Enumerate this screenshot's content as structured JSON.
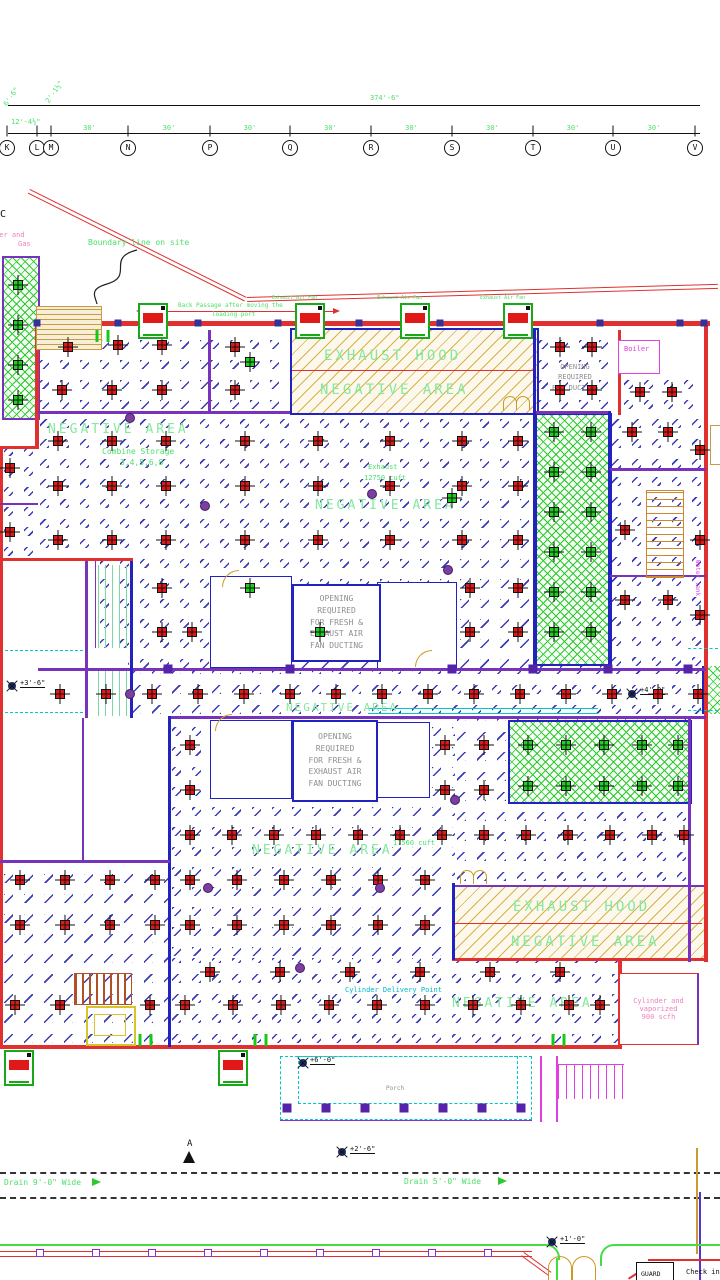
{
  "grid": {
    "xs": [
      7,
      37,
      51,
      128,
      210,
      290,
      371,
      452,
      533,
      613,
      695
    ],
    "bubbles": [
      "K",
      "L",
      "M",
      "N",
      "P",
      "Q",
      "R",
      "S",
      "T",
      "U",
      "V"
    ],
    "total": "374'-6\"",
    "bay": "30'",
    "sub1": "6'-6\"",
    "sub2": "12'-4½\"",
    "sub3": "2'-1½\"",
    "partial": "C"
  },
  "labels": {
    "boundary": "Boundary line on site",
    "back_passage_1": "Back Passage after moving the",
    "back_passage_2": "loading port",
    "exhaust_fan": "Exhaust Air Fan",
    "exhaust_hood": "EXHAUST HOOD",
    "negative_area": "NEGATIVE AREA",
    "combine_1": "Combine Storage",
    "combine_2": "3,4,5,6,8",
    "exhaust_word": "Exhaust",
    "cuft_1": "12750 cuft",
    "cuft_2": "17560 cuft",
    "opening_s": [
      "OPENING",
      "REQUIRED",
      "FOR DUCTING"
    ],
    "opening_f": [
      "OPENING",
      "REQUIRED",
      "FOR FRESH &",
      "EXHAUST AIR",
      "FAN DUCTING"
    ],
    "boiler": "Boiler",
    "water_tank": "Water tank",
    "cylinder": [
      "Cylinder and",
      "vaporized",
      "900 scfh"
    ],
    "corner_note": [
      "Cylinder and",
      "Gas"
    ],
    "delivery": "Cylinder Delivery Point",
    "porch": "Porch",
    "guard": "GUARD",
    "check_in": "Check in",
    "drain_left": "Drain 9'-0\" Wide",
    "drain_right": "Drain 5'-0\" Wide",
    "north": "A",
    "lvl_1": "+3'-6\"",
    "lvl_2": "+4'-0\"",
    "lvl_3": "+6'-0\"",
    "lvl_4": "+2'-6\"",
    "lvl_5": "+1'-0\""
  },
  "colors": {
    "wall_red": "#e03030",
    "wall_blue": "#2222c0",
    "wall_purple": "#7733bb",
    "hatch_blue": "#3a3ab8",
    "hatch_yellow": "#d9b13f",
    "cross_green": "#2ec82e",
    "cad_green": "#4ce06a",
    "cyan": "#00c8c8",
    "magenta": "#e040e0",
    "pink": "#f080c0",
    "gray": "#8f8f8f"
  },
  "symbols": {
    "red_diffusers": [
      [
        68,
        347
      ],
      [
        118,
        345
      ],
      [
        162,
        345
      ],
      [
        62,
        390
      ],
      [
        112,
        390
      ],
      [
        162,
        390
      ],
      [
        235,
        347
      ],
      [
        235,
        390
      ],
      [
        560,
        347
      ],
      [
        592,
        347
      ],
      [
        560,
        390
      ],
      [
        592,
        390
      ],
      [
        640,
        392
      ],
      [
        672,
        392
      ],
      [
        632,
        432
      ],
      [
        668,
        432
      ],
      [
        700,
        450
      ],
      [
        625,
        530
      ],
      [
        700,
        540
      ],
      [
        625,
        600
      ],
      [
        668,
        600
      ],
      [
        700,
        615
      ],
      [
        58,
        441
      ],
      [
        112,
        441
      ],
      [
        166,
        441
      ],
      [
        245,
        441
      ],
      [
        318,
        441
      ],
      [
        390,
        441
      ],
      [
        462,
        441
      ],
      [
        518,
        441
      ],
      [
        58,
        486
      ],
      [
        112,
        486
      ],
      [
        166,
        486
      ],
      [
        245,
        486
      ],
      [
        318,
        486
      ],
      [
        390,
        486
      ],
      [
        462,
        486
      ],
      [
        518,
        486
      ],
      [
        58,
        540
      ],
      [
        112,
        540
      ],
      [
        166,
        540
      ],
      [
        245,
        540
      ],
      [
        318,
        540
      ],
      [
        390,
        540
      ],
      [
        462,
        540
      ],
      [
        518,
        540
      ],
      [
        162,
        588
      ],
      [
        470,
        588
      ],
      [
        518,
        588
      ],
      [
        162,
        632
      ],
      [
        192,
        632
      ],
      [
        470,
        632
      ],
      [
        518,
        632
      ],
      [
        10,
        468
      ],
      [
        10,
        532
      ],
      [
        60,
        694
      ],
      [
        106,
        694
      ],
      [
        152,
        694
      ],
      [
        198,
        694
      ],
      [
        244,
        694
      ],
      [
        290,
        694
      ],
      [
        336,
        694
      ],
      [
        382,
        694
      ],
      [
        428,
        694
      ],
      [
        474,
        694
      ],
      [
        520,
        694
      ],
      [
        566,
        694
      ],
      [
        612,
        694
      ],
      [
        658,
        694
      ],
      [
        698,
        694
      ],
      [
        190,
        745
      ],
      [
        445,
        745
      ],
      [
        484,
        745
      ],
      [
        190,
        790
      ],
      [
        445,
        790
      ],
      [
        484,
        790
      ],
      [
        190,
        835
      ],
      [
        232,
        835
      ],
      [
        274,
        835
      ],
      [
        316,
        835
      ],
      [
        358,
        835
      ],
      [
        400,
        835
      ],
      [
        442,
        835
      ],
      [
        484,
        835
      ],
      [
        526,
        835
      ],
      [
        568,
        835
      ],
      [
        610,
        835
      ],
      [
        652,
        835
      ],
      [
        684,
        835
      ],
      [
        190,
        880
      ],
      [
        237,
        880
      ],
      [
        284,
        880
      ],
      [
        331,
        880
      ],
      [
        378,
        880
      ],
      [
        425,
        880
      ],
      [
        190,
        925
      ],
      [
        237,
        925
      ],
      [
        284,
        925
      ],
      [
        331,
        925
      ],
      [
        378,
        925
      ],
      [
        425,
        925
      ],
      [
        20,
        880
      ],
      [
        65,
        880
      ],
      [
        110,
        880
      ],
      [
        155,
        880
      ],
      [
        20,
        925
      ],
      [
        65,
        925
      ],
      [
        110,
        925
      ],
      [
        155,
        925
      ],
      [
        210,
        972
      ],
      [
        280,
        972
      ],
      [
        350,
        972
      ],
      [
        420,
        972
      ],
      [
        490,
        972
      ],
      [
        560,
        972
      ],
      [
        15,
        1005
      ],
      [
        60,
        1005
      ],
      [
        150,
        1005
      ],
      [
        185,
        1005
      ],
      [
        233,
        1005
      ],
      [
        281,
        1005
      ],
      [
        329,
        1005
      ],
      [
        377,
        1005
      ],
      [
        425,
        1005
      ],
      [
        473,
        1005
      ],
      [
        521,
        1005
      ],
      [
        569,
        1005
      ],
      [
        600,
        1005
      ]
    ],
    "green_diffusers": [
      [
        554,
        432
      ],
      [
        591,
        432
      ],
      [
        554,
        472
      ],
      [
        591,
        472
      ],
      [
        554,
        512
      ],
      [
        591,
        512
      ],
      [
        554,
        552
      ],
      [
        591,
        552
      ],
      [
        554,
        592
      ],
      [
        591,
        592
      ],
      [
        554,
        632
      ],
      [
        591,
        632
      ],
      [
        528,
        745
      ],
      [
        566,
        745
      ],
      [
        604,
        745
      ],
      [
        642,
        745
      ],
      [
        678,
        745
      ],
      [
        528,
        786
      ],
      [
        566,
        786
      ],
      [
        604,
        786
      ],
      [
        642,
        786
      ],
      [
        678,
        786
      ],
      [
        250,
        362
      ],
      [
        452,
        498
      ],
      [
        250,
        588
      ],
      [
        320,
        632
      ],
      [
        18,
        285
      ],
      [
        18,
        325
      ],
      [
        18,
        365
      ],
      [
        18,
        400
      ]
    ],
    "purple_junctions": [
      [
        130,
        418
      ],
      [
        205,
        506
      ],
      [
        372,
        494
      ],
      [
        448,
        570
      ],
      [
        455,
        800
      ],
      [
        380,
        888
      ],
      [
        208,
        888
      ],
      [
        300,
        968
      ],
      [
        130,
        694
      ]
    ],
    "wall_columns": [
      [
        37,
        323
      ],
      [
        118,
        323
      ],
      [
        198,
        323
      ],
      [
        278,
        323
      ],
      [
        359,
        323
      ],
      [
        440,
        323
      ],
      [
        520,
        323
      ],
      [
        600,
        323
      ],
      [
        680,
        323
      ],
      [
        704,
        323
      ]
    ],
    "corridor_columns": [
      [
        168,
        669
      ],
      [
        290,
        669
      ],
      [
        452,
        669
      ],
      [
        533,
        669
      ],
      [
        608,
        669
      ],
      [
        688,
        669
      ]
    ],
    "fence_posts": [
      [
        40,
        1253
      ],
      [
        96,
        1253
      ],
      [
        152,
        1253
      ],
      [
        208,
        1253
      ],
      [
        264,
        1253
      ],
      [
        320,
        1253
      ],
      [
        376,
        1253
      ],
      [
        432,
        1253
      ],
      [
        488,
        1253
      ]
    ],
    "porch_columns": [
      [
        287,
        1108
      ],
      [
        326,
        1108
      ],
      [
        365,
        1108
      ],
      [
        404,
        1108
      ],
      [
        443,
        1108
      ],
      [
        482,
        1108
      ],
      [
        521,
        1108
      ]
    ],
    "green_bars": [
      [
        97,
        336
      ],
      [
        108,
        336
      ],
      [
        140,
        1040
      ],
      [
        151,
        1040
      ],
      [
        255,
        1040
      ],
      [
        266,
        1040
      ],
      [
        553,
        1040
      ],
      [
        564,
        1040
      ]
    ],
    "fans_top": [
      [
        138,
        303
      ],
      [
        295,
        303
      ],
      [
        400,
        303
      ],
      [
        503,
        303
      ]
    ],
    "fans_bottom": [
      [
        4,
        1050
      ],
      [
        218,
        1050
      ]
    ]
  }
}
